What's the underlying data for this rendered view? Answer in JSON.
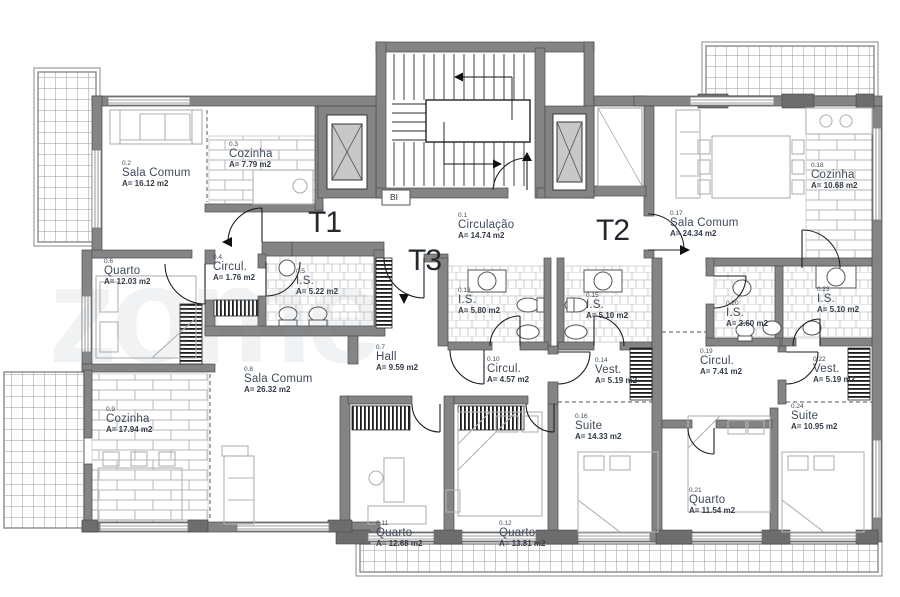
{
  "watermark": "zome",
  "colors": {
    "wall": "#848484",
    "pillar": "#6d6d6d",
    "text": "#3f4a5a",
    "line": "#222222"
  },
  "apartments": [
    {
      "id": "t1",
      "label": "T1"
    },
    {
      "id": "t2",
      "label": "T2"
    },
    {
      "id": "t3",
      "label": "T3"
    }
  ],
  "bi_label": "BI",
  "rooms": [
    {
      "number": "0.1",
      "name": "Circulação",
      "area": "A= 14.74 m2"
    },
    {
      "number": "0.2",
      "name": "Sala Comum",
      "area": "A= 16.12 m2"
    },
    {
      "number": "0.3",
      "name": "Cozinha",
      "area": "A= 7.79 m2"
    },
    {
      "number": "0.4",
      "name": "Circul.",
      "area": "A= 1.76 m2"
    },
    {
      "number": "0.5",
      "name": "I.S.",
      "area": "A= 5.22 m2"
    },
    {
      "number": "0.6",
      "name": "Quarto",
      "area": "A= 12.03 m2"
    },
    {
      "number": "0.7",
      "name": "Hall",
      "area": "A= 9.59 m2"
    },
    {
      "number": "0.8",
      "name": "Sala Comum",
      "area": "A= 26.32 m2"
    },
    {
      "number": "0.9",
      "name": "Cozinha",
      "area": "A= 17.94 m2"
    },
    {
      "number": "0.10",
      "name": "Circul.",
      "area": "A= 4.57 m2"
    },
    {
      "number": "0.11",
      "name": "Quarto",
      "area": "A= 12.68 m2"
    },
    {
      "number": "0.12",
      "name": "Quarto",
      "area": "A= 13.81 m2"
    },
    {
      "number": "0.13",
      "name": "I.S.",
      "area": "A= 5.80 m2"
    },
    {
      "number": "0.14",
      "name": "Vest.",
      "area": "A= 5.19 m2"
    },
    {
      "number": "0.15",
      "name": "I.S.",
      "area": "A= 5.10 m2"
    },
    {
      "number": "0.16",
      "name": "Suite",
      "area": "A= 14.33 m2"
    },
    {
      "number": "0.17",
      "name": "Sala Comum",
      "area": "A= 24.34 m2"
    },
    {
      "number": "0.18",
      "name": "Cozinha",
      "area": "A= 10.68 m2"
    },
    {
      "number": "0.19",
      "name": "Circul.",
      "area": "A= 7.41 m2"
    },
    {
      "number": "0.20",
      "name": "I.S.",
      "area": "A= 3.60 m2"
    },
    {
      "number": "0.21",
      "name": "Quarto",
      "area": "A= 11.54 m2"
    },
    {
      "number": "0.22",
      "name": "Vest.",
      "area": "A= 5.19 m2"
    },
    {
      "number": "0.23",
      "name": "I.S.",
      "area": "A= 5.10 m2"
    },
    {
      "number": "0.24",
      "name": "Suite",
      "area": "A= 10.95 m2"
    }
  ]
}
